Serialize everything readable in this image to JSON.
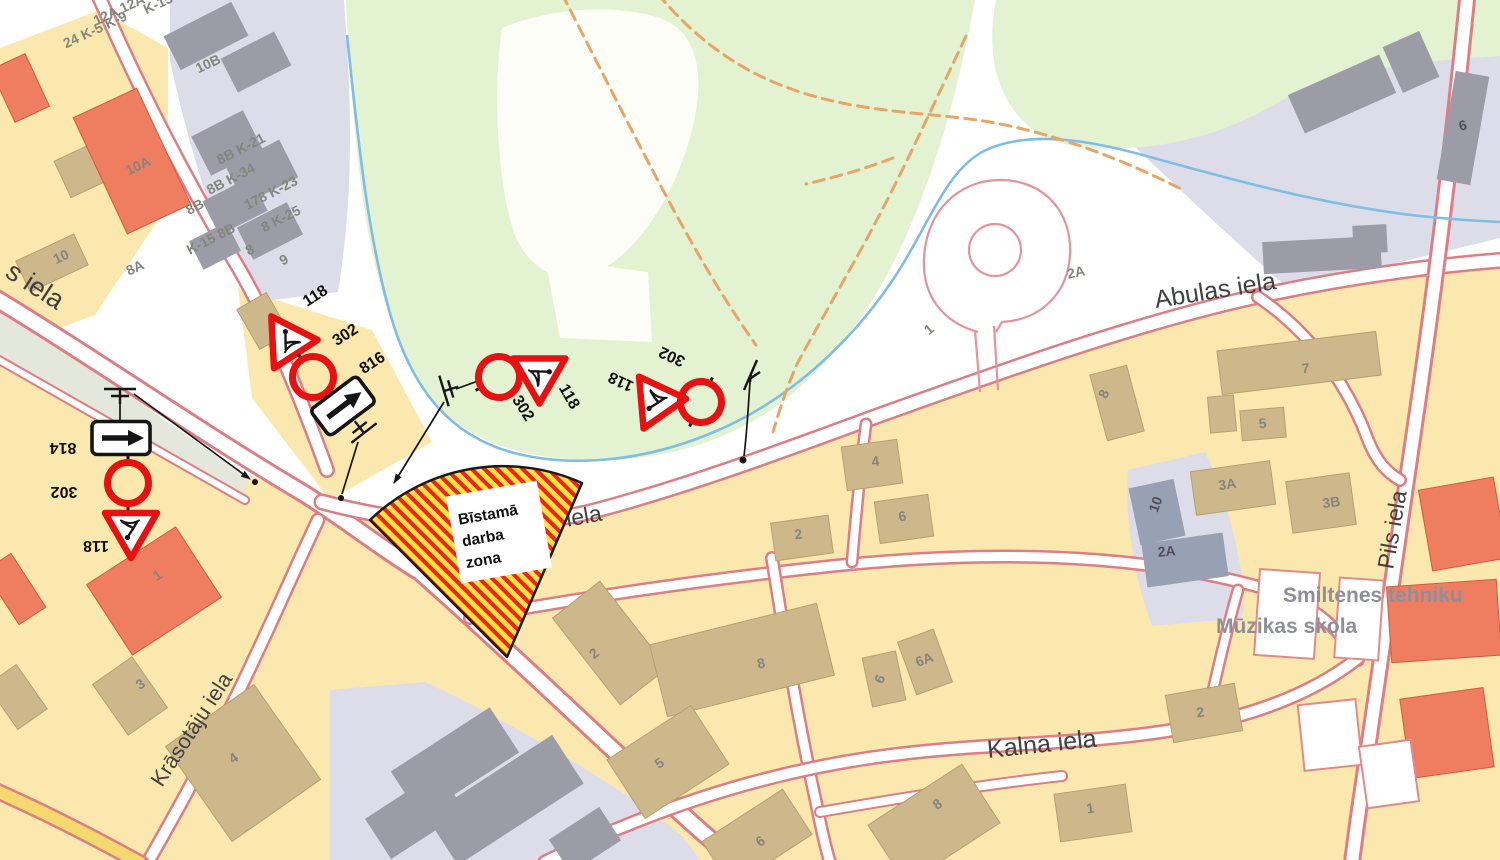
{
  "streets": {
    "left_partial": "s iela",
    "krasotaju": "Krāsotāju iela",
    "abulas_zone": "Abulas iela",
    "abulas_top": "Abulas iela",
    "kalna": "Kalna iela",
    "pils": "Pils iela"
  },
  "places": {
    "tehnikums": "Smiltenes tehniku",
    "muzikas": "Mūzikas skola"
  },
  "zone": {
    "line1": "Bīstamā",
    "line2": "darba",
    "line3": "zona"
  },
  "signs": {
    "g1": [
      "814",
      "302",
      "118"
    ],
    "g2": [
      "118",
      "302",
      "816"
    ],
    "g3": [
      "302",
      "118"
    ],
    "g4": [
      "302",
      "118"
    ]
  },
  "buildings": [
    "12A 12A",
    "24 K-5 K-9",
    "K-15",
    "10B",
    "8B K-21",
    "8B K-34",
    "178 K-23",
    "8 K-25",
    "8B",
    "K-15 8B",
    "8",
    "9",
    "10A",
    "10",
    "8A",
    "1",
    "3",
    "4",
    "1",
    "2A",
    "8",
    "7",
    "5",
    "3A",
    "3B",
    "10",
    "2A",
    "2",
    "8",
    "6",
    "6A",
    "5",
    "6",
    "8",
    "4",
    "6",
    "2",
    "2",
    "1",
    "6"
  ],
  "colors": {
    "c_sign_red": "#e81111",
    "c_zone_red": "#ee2222",
    "c_zone_yellow": "#ffe23c",
    "c_casing": "#dd7d84",
    "c_yellow": "#fbe8ae",
    "c_green": "#e3f2d0",
    "c_lav": "#dcdde9",
    "c_tan": "#cdb88c",
    "c_gray": "#9b9ca6",
    "c_orange": "#ef7e60",
    "c_stream": "#7fbde4",
    "c_trail": "#e7a567"
  }
}
